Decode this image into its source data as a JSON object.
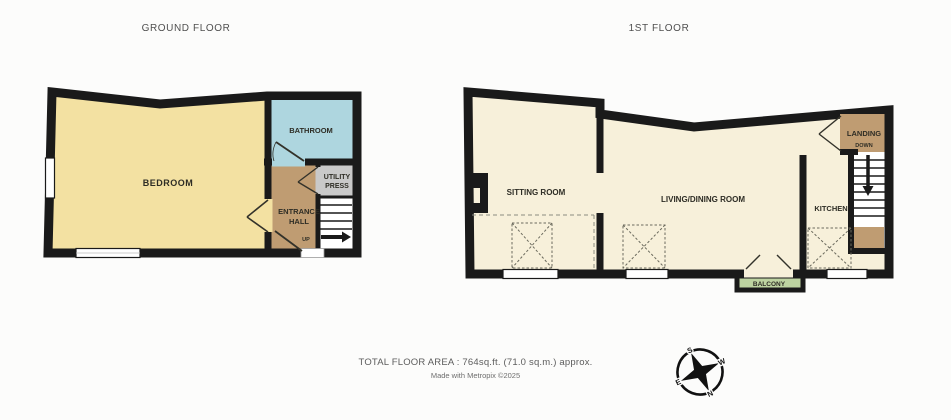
{
  "ground_floor": {
    "title": "GROUND FLOOR",
    "labels": {
      "bedroom": "BEDROOM",
      "bathroom": "BATHROOM",
      "entrance_hall_line1": "ENTRANCE",
      "entrance_hall_line2": "HALL",
      "utility_line1": "UTILITY",
      "utility_line2": "PRESS",
      "stairs_direction": "UP"
    }
  },
  "first_floor": {
    "title": "1ST FLOOR",
    "labels": {
      "sitting_room": "SITTING ROOM",
      "living_dining": "LIVING/DINING ROOM",
      "kitchen": "KITCHEN",
      "landing": "LANDING",
      "stairs_direction": "DOWN",
      "balcony": "BALCONY"
    }
  },
  "compass": {
    "north": "N",
    "south": "S",
    "east": "E",
    "west": "W"
  },
  "footer": {
    "total_area": "TOTAL FLOOR AREA : 764sq.ft. (71.0 sq.m.) approx.",
    "credit": "Made with Metropix ©2025"
  },
  "colors": {
    "wall": "#1a1a1a",
    "ground_room": "#f3e1a2",
    "bathroom": "#aed6df",
    "hall_landing": "#bf9c72",
    "utility": "#c9c9c9",
    "first_room": "#f7f0da",
    "balcony": "#bdd3a1"
  }
}
